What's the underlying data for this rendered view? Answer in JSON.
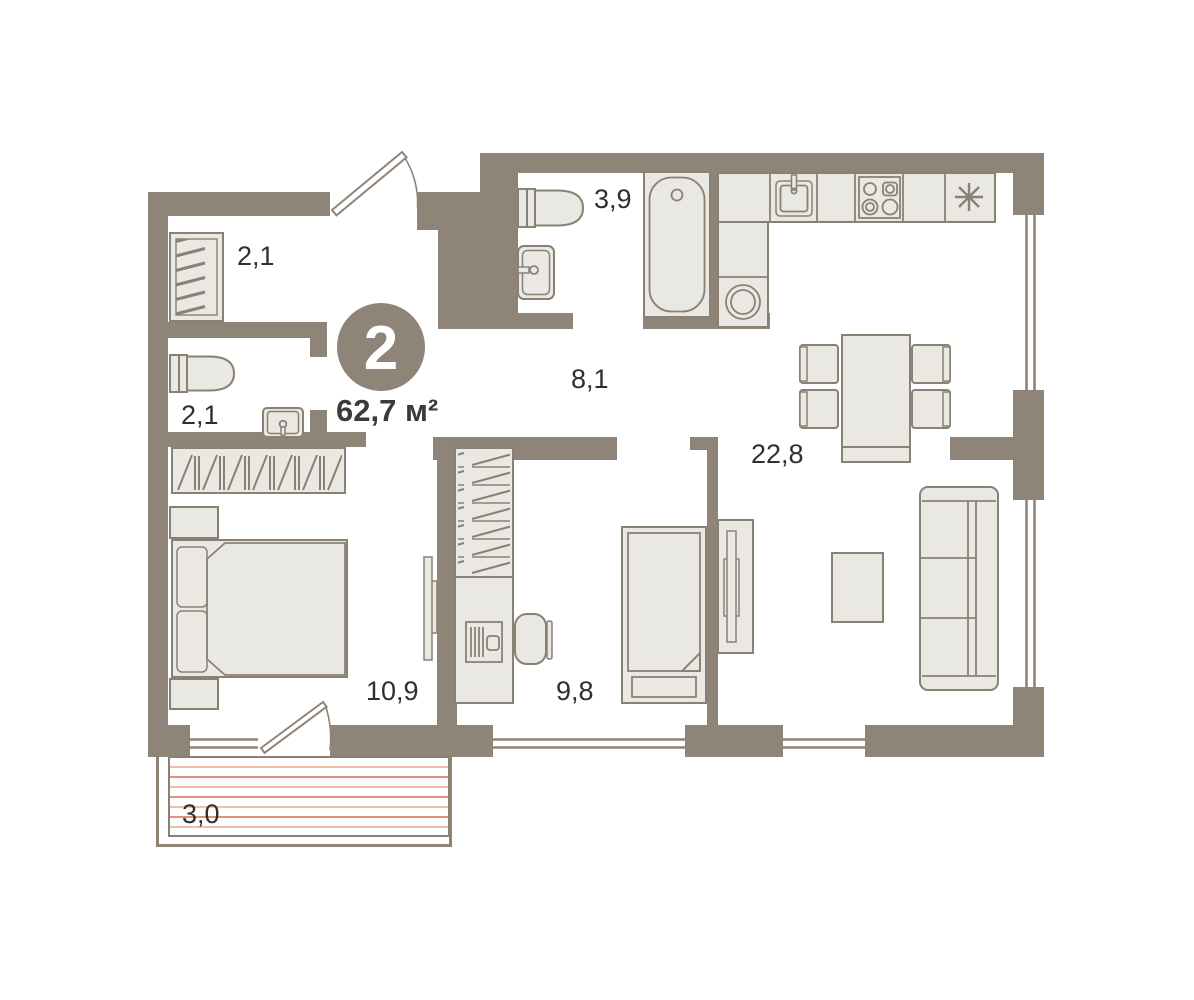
{
  "plan": {
    "title": "2-room apartment floor plan",
    "badge": {
      "rooms_count": "2",
      "total_area": "62,7 м²"
    },
    "rooms": [
      {
        "id": "entry-closet",
        "area": "2,1"
      },
      {
        "id": "wc",
        "area": "2,1"
      },
      {
        "id": "bathroom",
        "area": "3,9"
      },
      {
        "id": "hallway",
        "area": "8,1"
      },
      {
        "id": "kitchen-living",
        "area": "22,8"
      },
      {
        "id": "bedroom",
        "area": "10,9"
      },
      {
        "id": "study",
        "area": "9,8"
      },
      {
        "id": "balcony",
        "area": "3,0"
      }
    ],
    "icons": {
      "fridge": "snowflake-asterisk"
    },
    "colors": {
      "wall": "#8e8478",
      "furniture_fill": "#eae8e2",
      "furniture_stroke": "#8a8175",
      "text": "#2f2f2f",
      "balcony_hatch_light": "#edaa8e",
      "balcony_hatch_dark": "#d96f49",
      "badge_fill": "#8e8478",
      "badge_text": "#ffffff"
    }
  }
}
